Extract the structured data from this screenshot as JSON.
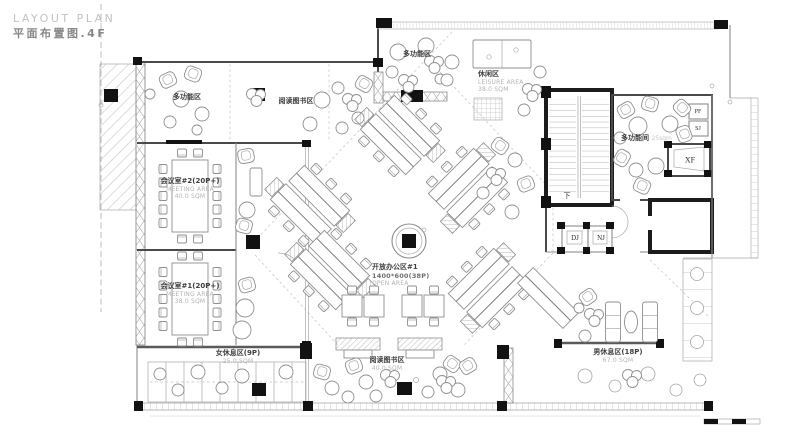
{
  "title": {
    "en": "LAYOUT PLAN",
    "zh": "平面布置图.4F"
  },
  "rooms": {
    "multi_tl": {
      "zh": "多功能区"
    },
    "reading_top": {
      "zh": "阅读图书区"
    },
    "multi_tc": {
      "zh": "多功能区"
    },
    "leisure": {
      "zh": "休闲区",
      "en": "LEISURE AREA",
      "area": "38.0 SQM"
    },
    "meeting2": {
      "zh": "会议室#2(20P+)",
      "en": "MEETING AREA",
      "area": "40.0 SQM"
    },
    "meeting1": {
      "zh": "会议室#1(20P+)",
      "en": "MEETING AREA",
      "area": "38.0 SQM"
    },
    "women_rest": {
      "zh": "女休息区(9P)",
      "area": "25.0 SQM"
    },
    "open_office": {
      "zh": "开放办公区#1",
      "spec": "1400*600(38P)",
      "en": "OPEN AREA"
    },
    "reading_bottom": {
      "zh": "阅读图书区",
      "area": "40.0 SQM"
    },
    "men_rest": {
      "zh": "男休息区(18P)",
      "area": "67.0 SQM"
    },
    "multi_room": {
      "zh": "多功能间",
      "area": "25sqm"
    }
  },
  "shafts": {
    "xf": "XF",
    "dj": "DJ",
    "nj": "NJ",
    "pf": "PF",
    "sj": "SJ"
  },
  "stairs": {
    "down": "下"
  },
  "colors": {
    "wall": "#4a4a4a",
    "column": "#121212",
    "furniture": "#8f8f8f",
    "hatch": "#c5c5c5",
    "label": "#3d3d3d",
    "label_sub": "#b3b3b3"
  }
}
